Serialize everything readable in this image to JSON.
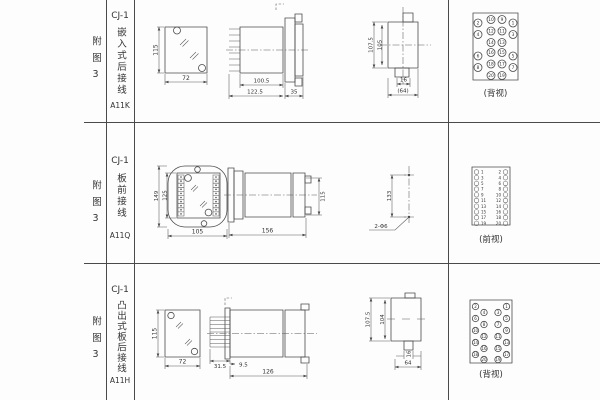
{
  "sheet": {
    "line_color": "#4a4a4a",
    "rows": [
      {
        "fig_label": "附图3",
        "model": "CJ-1",
        "type_text": "嵌入式后接线",
        "code": "A11K",
        "caption": "(背视)",
        "dims": {
          "height": "115",
          "width": "72",
          "body_len": "100.5",
          "total_len": "122.5",
          "flange": "35",
          "outer_h": "107.5",
          "inner_h": "105",
          "tab": "16",
          "width2": "(64)"
        }
      },
      {
        "fig_label": "附图3",
        "model": "CJ-1",
        "type_text": "板前接线",
        "code": "A11Q",
        "caption": "(前视)",
        "dims": {
          "plate_h": "149",
          "rect_h": "125",
          "width": "105",
          "length": "156",
          "height": "115",
          "hole_span": "133",
          "holes": "2-Φ6"
        }
      },
      {
        "fig_label": "附图3",
        "model": "CJ-1",
        "type_text": "凸出式板后接线",
        "code": "A11H",
        "caption": "(背视)",
        "dims": {
          "height": "115",
          "width": "72",
          "pins": "31.5",
          "offset": "9.5",
          "body_len": "126",
          "outer_h": "107.5",
          "inner_h": "104",
          "tab": "16",
          "width2": "64"
        }
      }
    ],
    "terminals": {
      "back_top": [
        "2",
        "10",
        "9",
        "1",
        "4",
        "12",
        "11",
        "3",
        "14",
        "13",
        "6",
        "16",
        "15",
        "5",
        "8",
        "18",
        "17",
        "7",
        "20",
        "19"
      ],
      "front_left": [
        "1",
        "3",
        "5",
        "7",
        "9",
        "11",
        "13",
        "15",
        "17",
        "19"
      ],
      "front_right": [
        "2",
        "4",
        "6",
        "8",
        "10",
        "12",
        "14",
        "16",
        "18",
        "20"
      ],
      "back_bottom_left_outer": [
        "2",
        "6",
        "10",
        "14",
        "18"
      ],
      "back_bottom_left_inner": [
        "4",
        "8",
        "12",
        "16",
        "20"
      ],
      "back_bottom_right_inner": [
        "3",
        "7",
        "11",
        "15",
        "19"
      ],
      "back_bottom_right_outer": [
        "1",
        "5",
        "9",
        "13",
        "17"
      ]
    }
  }
}
